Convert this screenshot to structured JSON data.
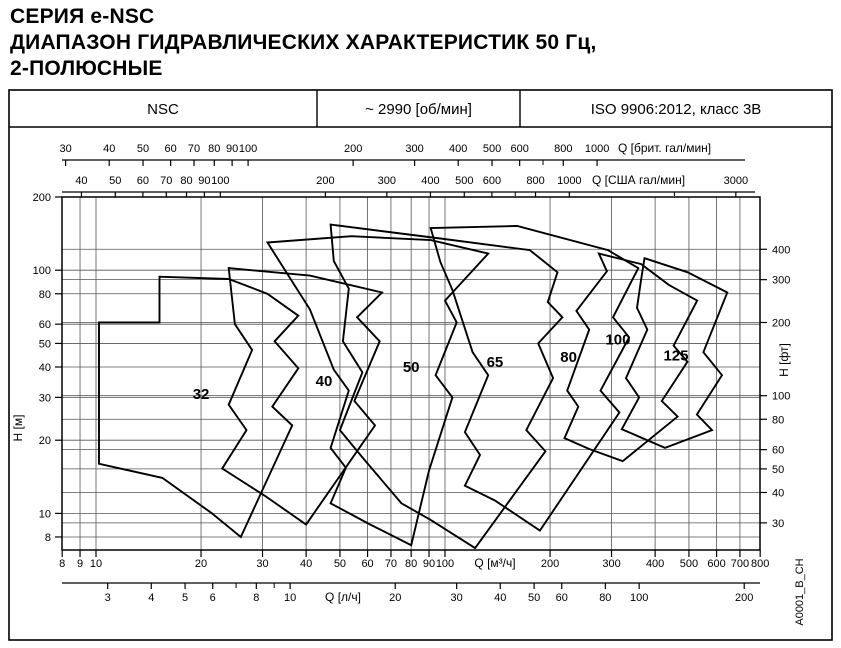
{
  "title": {
    "line1": "СЕРИЯ e-NSC",
    "line2": "ДИАПАЗОН ГИДРАВЛИЧЕСКИХ ХАРАКТЕРИСТИК 50 Гц,",
    "line3": "2-ПОЛЮСНЫЕ"
  },
  "header": {
    "series": "NSC",
    "speed": "~ 2990 [об/мин]",
    "standard": "ISO 9906:2012, класс 3В"
  },
  "side_note": "A0001_B_CH",
  "colors": {
    "ink": "#000000",
    "grid": "#555555"
  },
  "chart_data": {
    "type": "area",
    "title": "Hydraulic range 50 Hz, 2-pole",
    "x_axis": {
      "label": "Q [м³/ч]",
      "scale": "log",
      "min": 8,
      "max": 800,
      "ticks": [
        8,
        9,
        10,
        20,
        30,
        40,
        50,
        60,
        70,
        80,
        90,
        100,
        200,
        300,
        400,
        500,
        600,
        700,
        800
      ]
    },
    "y_axis": {
      "label": "H [м]",
      "scale": "log",
      "min": 7.1,
      "max": 200,
      "ticks": [
        200,
        100,
        80,
        60,
        50,
        40,
        30,
        20,
        10,
        8
      ]
    },
    "y2_axis": {
      "label": "H [фт]",
      "m_per_unit": 0.3048,
      "ticks": [
        400,
        300,
        200,
        100,
        80,
        60,
        50,
        40,
        30
      ]
    },
    "top_axis_imp": {
      "label": "Q [брит. гал/мин]",
      "m3h_per_unit": 0.27276,
      "ticks": [
        30,
        40,
        50,
        60,
        70,
        80,
        90,
        100,
        200,
        300,
        400,
        500,
        600,
        800,
        1000
      ],
      "minor": [
        700
      ]
    },
    "top_axis_us": {
      "label": "Q [США гал/мин]",
      "m3h_per_unit": 0.22712,
      "ticks": [
        40,
        50,
        60,
        70,
        80,
        90,
        100,
        200,
        300,
        400,
        500,
        600,
        800,
        1000,
        3000
      ],
      "minor": [
        700,
        2000
      ]
    },
    "bottom_axis_ls": {
      "label": "Q [л/ч]",
      "m3h_per_unit": 3.6,
      "ticks": [
        3,
        4,
        5,
        6,
        8,
        10,
        20,
        30,
        40,
        50,
        60,
        80,
        100,
        200
      ],
      "minor": [
        7,
        9
      ]
    },
    "grid": true,
    "legend": "labels inside zones",
    "zones": [
      {
        "label": "32",
        "label_at": [
          20,
          31
        ],
        "points": [
          [
            10.2,
            61
          ],
          [
            15.2,
            61
          ],
          [
            15.2,
            94
          ],
          [
            24,
            92
          ],
          [
            31,
            80
          ],
          [
            38,
            65
          ],
          [
            32.5,
            51
          ],
          [
            38,
            39.5
          ],
          [
            32,
            27.5
          ],
          [
            36.5,
            23
          ],
          [
            26,
            8
          ],
          [
            21.5,
            10
          ],
          [
            15.5,
            14
          ],
          [
            10.2,
            16
          ]
        ]
      },
      {
        "label": "40",
        "label_at": [
          45,
          35
        ],
        "points": [
          [
            24,
            102
          ],
          [
            41,
            95
          ],
          [
            66,
            81
          ],
          [
            56,
            64
          ],
          [
            65,
            51
          ],
          [
            55,
            29
          ],
          [
            63,
            23
          ],
          [
            40,
            9
          ],
          [
            30.5,
            11.8
          ],
          [
            23,
            15.3
          ],
          [
            27,
            22
          ],
          [
            24,
            28
          ],
          [
            28,
            47
          ],
          [
            25,
            60
          ]
        ]
      },
      {
        "label": "50",
        "label_at": [
          80,
          40
        ],
        "points": [
          [
            31,
            130
          ],
          [
            54,
            138
          ],
          [
            91,
            133
          ],
          [
            133,
            117
          ],
          [
            100,
            75
          ],
          [
            108,
            61
          ],
          [
            94,
            37
          ],
          [
            105,
            30
          ],
          [
            90,
            15
          ],
          [
            80,
            7.4
          ],
          [
            61,
            9
          ],
          [
            47,
            11
          ],
          [
            52,
            15.4
          ],
          [
            47,
            18.6
          ],
          [
            53,
            32
          ],
          [
            48,
            39
          ],
          [
            41,
            69
          ],
          [
            37,
            87
          ]
        ]
      },
      {
        "label": "65",
        "label_at": [
          139,
          42
        ],
        "points": [
          [
            47,
            154
          ],
          [
            97,
            135
          ],
          [
            175,
            121
          ],
          [
            210,
            98
          ],
          [
            197,
            74
          ],
          [
            217,
            64
          ],
          [
            185,
            50
          ],
          [
            204,
            36
          ],
          [
            171,
            22
          ],
          [
            194,
            18
          ],
          [
            122,
            7.2
          ],
          [
            91,
            9.4
          ],
          [
            75,
            11
          ],
          [
            58,
            17
          ],
          [
            50,
            22
          ],
          [
            58,
            38
          ],
          [
            51,
            51
          ],
          [
            53,
            84
          ],
          [
            48,
            109
          ]
        ]
      },
      {
        "label": "80",
        "label_at": [
          226,
          44
        ],
        "points": [
          [
            91,
            149
          ],
          [
            161,
            152
          ],
          [
            293,
            121
          ],
          [
            358,
            102
          ],
          [
            303,
            64
          ],
          [
            337,
            53
          ],
          [
            279,
            32
          ],
          [
            316,
            26
          ],
          [
            187,
            8.5
          ],
          [
            139,
            11.3
          ],
          [
            114,
            13
          ],
          [
            126,
            17.4
          ],
          [
            114,
            21.6
          ],
          [
            133,
            37
          ],
          [
            120,
            46
          ],
          [
            105,
            83
          ],
          [
            97,
            108
          ]
        ]
      },
      {
        "label": "100",
        "label_at": [
          313,
          52
        ],
        "points": [
          [
            276,
            117
          ],
          [
            365,
            106
          ],
          [
            438,
            87
          ],
          [
            528,
            75
          ],
          [
            452,
            49
          ],
          [
            495,
            42
          ],
          [
            418,
            29
          ],
          [
            464,
            25
          ],
          [
            323,
            16.4
          ],
          [
            259,
            18.4
          ],
          [
            220,
            20.4
          ],
          [
            241,
            27.5
          ],
          [
            224,
            32
          ],
          [
            259,
            57
          ],
          [
            238,
            68
          ],
          [
            291,
            99
          ]
        ]
      },
      {
        "label": "125",
        "label_at": [
          459,
          44.5
        ],
        "points": [
          [
            373,
            112
          ],
          [
            496,
            98
          ],
          [
            644,
            81
          ],
          [
            550,
            46
          ],
          [
            622,
            37
          ],
          [
            527,
            25.5
          ],
          [
            582,
            22
          ],
          [
            427,
            18.6
          ],
          [
            321,
            22.2
          ],
          [
            360,
            30
          ],
          [
            330,
            36
          ],
          [
            380,
            57
          ],
          [
            355,
            70
          ],
          [
            365,
            92
          ]
        ]
      }
    ]
  }
}
